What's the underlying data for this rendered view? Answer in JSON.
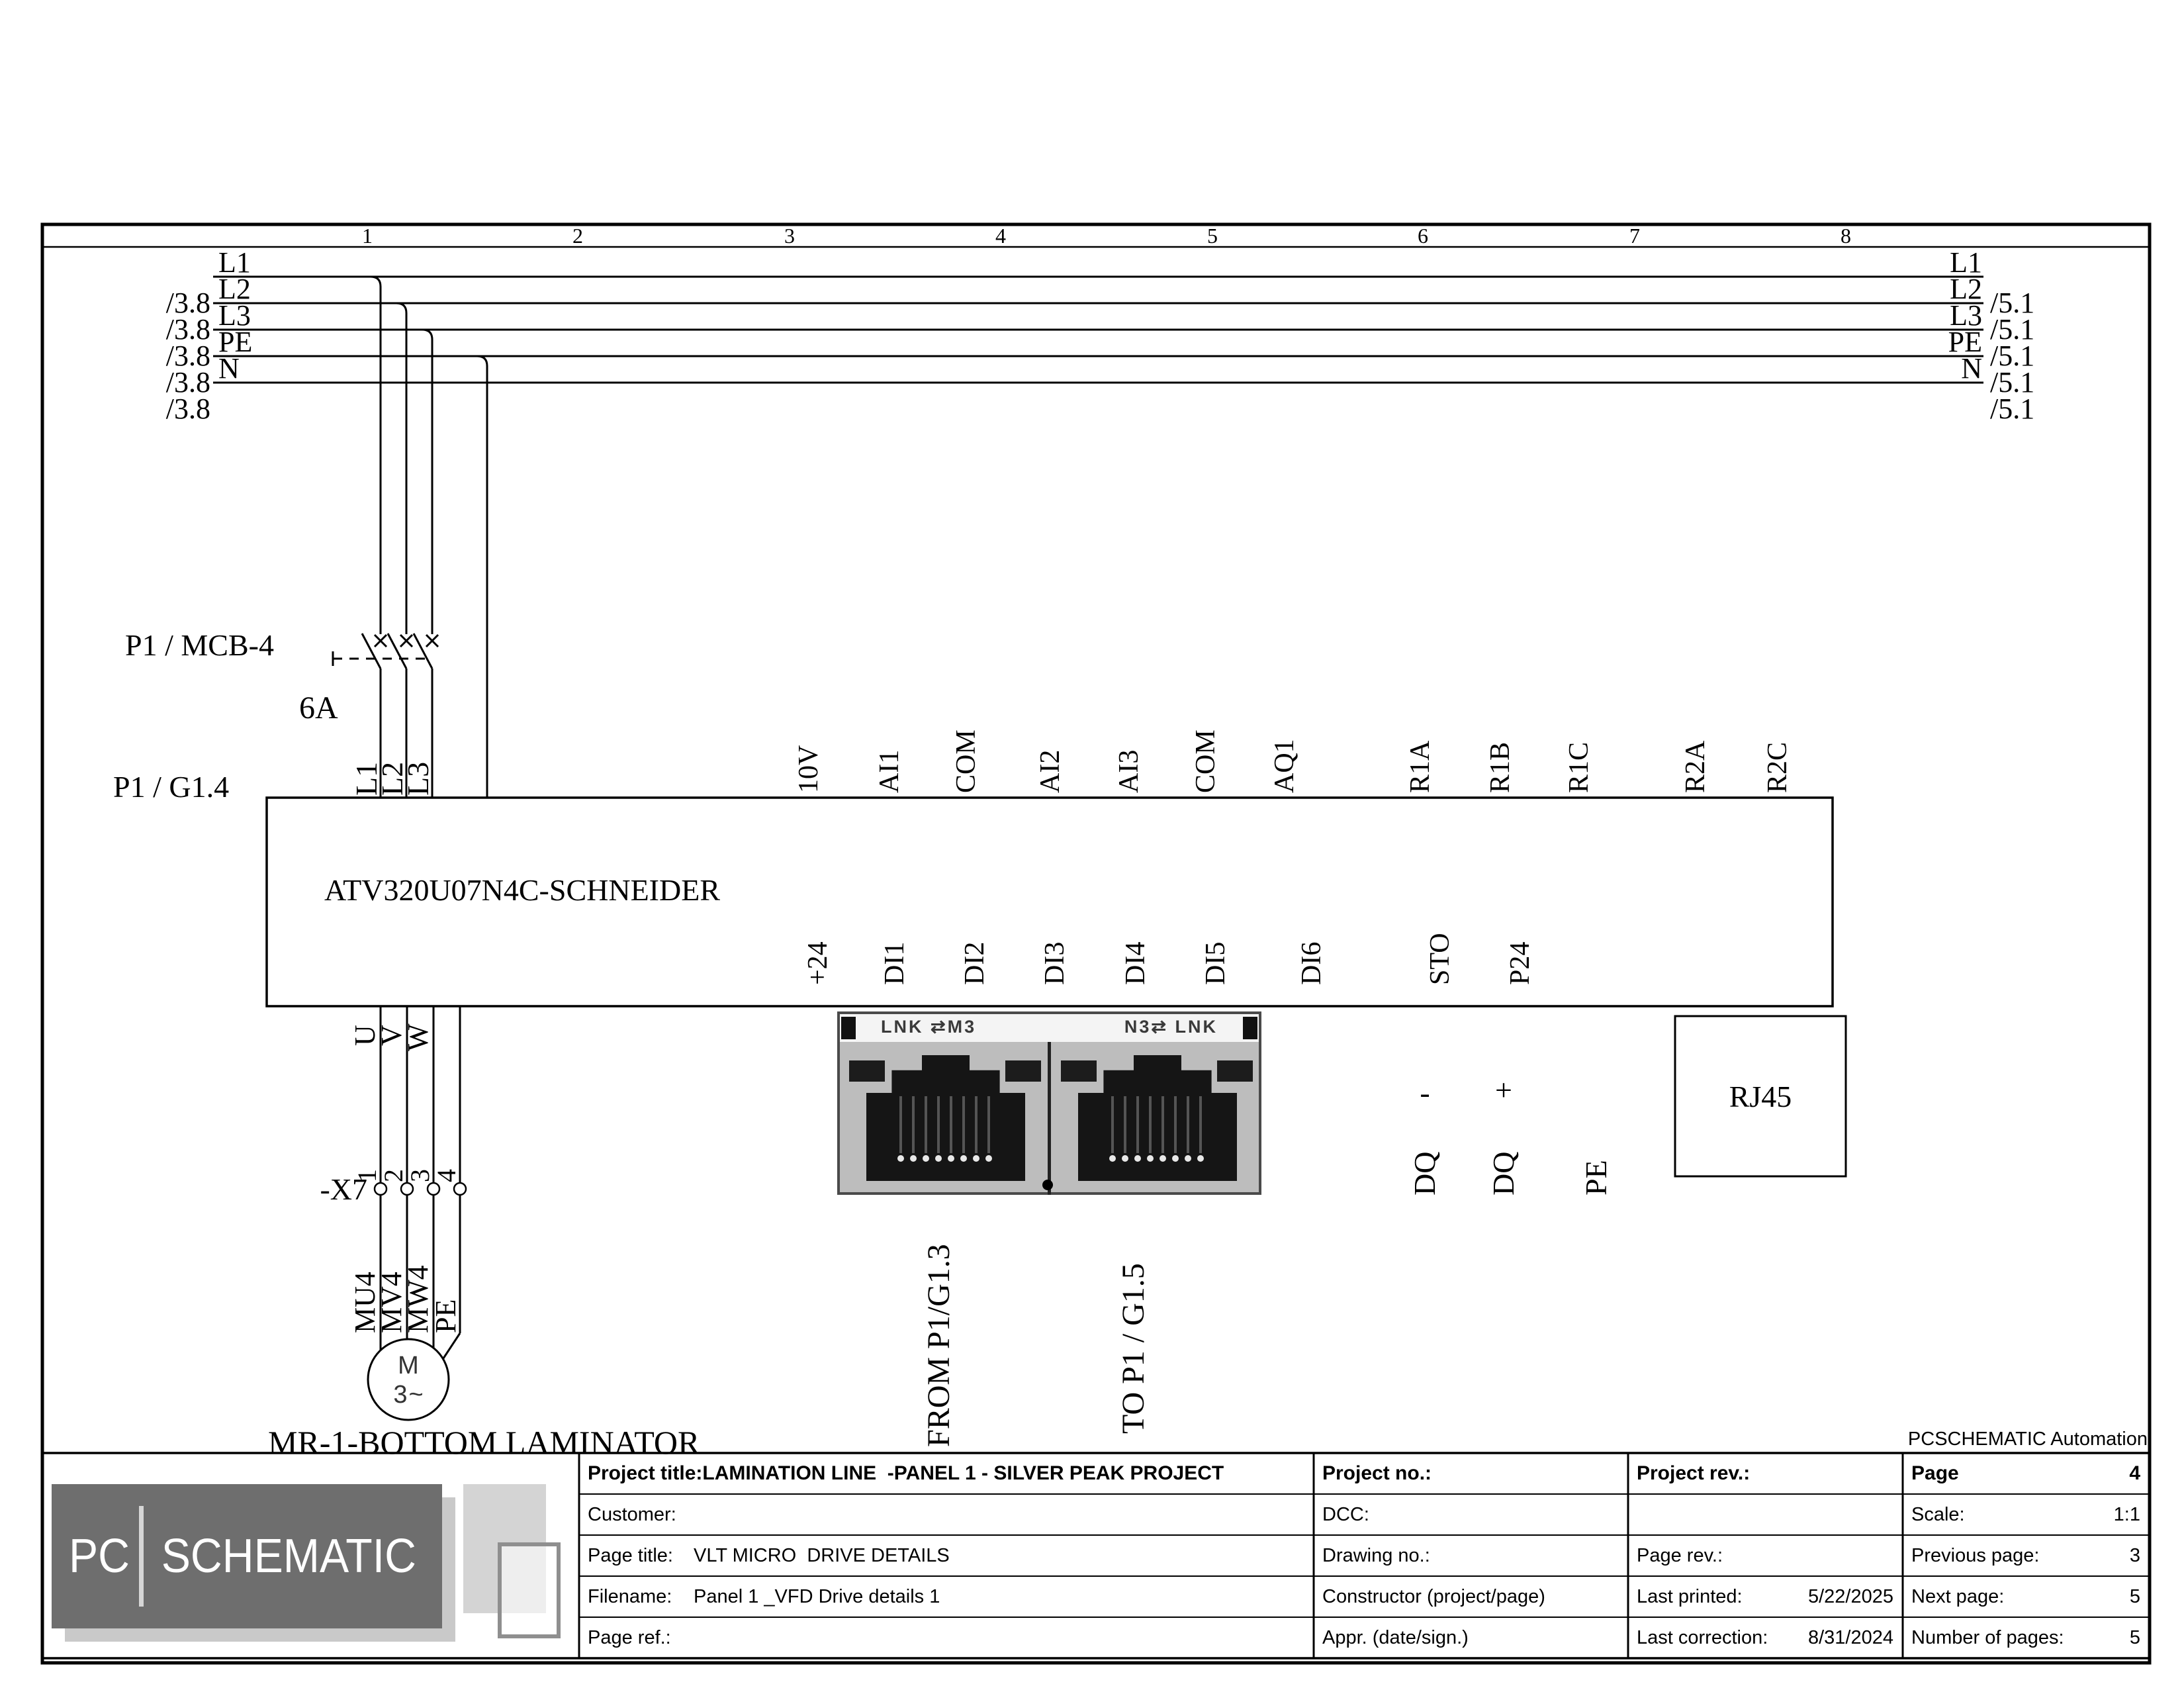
{
  "colors": {
    "ink": "#000000",
    "paper": "#ffffff",
    "logo_gray": "#6e6e6e",
    "logo_shadow": "#c9c9c9",
    "photo_body": "#bdbdbd",
    "photo_dark": "#151515"
  },
  "sheet": {
    "columns": [
      "1",
      "2",
      "3",
      "4",
      "5",
      "6",
      "7",
      "8"
    ],
    "watermark": "PCSCHEMATIC Automation"
  },
  "bus": {
    "left": [
      {
        "ref": "",
        "name": "L1"
      },
      {
        "ref": "/3.8",
        "name": "L2"
      },
      {
        "ref": "/3.8",
        "name": "L3"
      },
      {
        "ref": "/3.8",
        "name": "PE"
      },
      {
        "ref": "/3.8",
        "name": "N"
      },
      {
        "ref": "/3.8",
        "name": ""
      }
    ],
    "right": [
      {
        "name": "L1",
        "ref": ""
      },
      {
        "name": "L2",
        "ref": "/5.1"
      },
      {
        "name": "L3",
        "ref": "/5.1"
      },
      {
        "name": "PE",
        "ref": "/5.1"
      },
      {
        "name": "N",
        "ref": "/5.1"
      },
      {
        "name": "",
        "ref": "/5.1"
      }
    ]
  },
  "breaker": {
    "tag": "P1 / MCB-4",
    "rating": "6A",
    "feed_ref": "P1 / G1.4",
    "phases": [
      "L1",
      "L2",
      "L3"
    ]
  },
  "drive": {
    "model": "ATV320U07N4C-SCHNEIDER",
    "top_terminals": [
      "10V",
      "AI1",
      "COM",
      "AI2",
      "AI3",
      "COM",
      "AQ1",
      "R1A",
      "R1B",
      "R1C",
      "R2A",
      "R2C"
    ],
    "bottom_terminals": [
      "+24",
      "DI1",
      "DI2",
      "DI3",
      "DI4",
      "DI5",
      "DI6",
      "STO",
      "P24"
    ],
    "aux_terminals": [
      {
        "name": "DQ",
        "sign": "-"
      },
      {
        "name": "DQ",
        "sign": "+"
      },
      {
        "name": "PE",
        "sign": ""
      }
    ],
    "output_terminals": [
      "U",
      "V",
      "W"
    ],
    "rj45_label": "RJ45"
  },
  "comm": {
    "left_port": "LNK ⇄M3",
    "right_port": "N3⇄ LNK",
    "from_label": "FROM P1/G1.3",
    "to_label": "TO P1 / G1.5"
  },
  "x7": {
    "tag": "-X7",
    "pins": [
      "1",
      "2",
      "3",
      "4"
    ]
  },
  "motor": {
    "wires": [
      "MU4",
      "MV4",
      "MW4",
      "PE"
    ],
    "symbol_m": "M",
    "symbol_phase": "3~",
    "name": "MR-1-BOTTOM LAMINATOR"
  },
  "logo": {
    "pc": "PC",
    "schematic": "SCHEMATIC"
  },
  "title_block": {
    "project_title_label": "Project title:",
    "project_title": "LAMINATION LINE  -PANEL 1 - SILVER PEAK PROJECT",
    "customer_label": "Customer:",
    "page_title_label": "Page title:",
    "page_title": "VLT MICRO  DRIVE DETAILS",
    "filename_label": "Filename:",
    "filename": "Panel 1 _VFD Drive details 1",
    "page_ref_label": "Page ref.:",
    "project_no_label": "Project no.:",
    "dcc_label": "DCC:",
    "drawing_no_label": "Drawing no.:",
    "constructor_label": "Constructor (project/page)",
    "appr_label": "Appr. (date/sign.)",
    "project_rev_label": "Project rev.:",
    "page_rev_label": "Page rev.:",
    "last_printed_label": "Last printed:",
    "last_printed": "5/22/2025",
    "last_correction_label": "Last correction:",
    "last_correction": "8/31/2024",
    "page_label": "Page",
    "page": "4",
    "scale_label": "Scale:",
    "scale": "1:1",
    "previous_page_label": "Previous page:",
    "previous_page": "3",
    "next_page_label": "Next page:",
    "next_page": "5",
    "num_pages_label": "Number of pages:",
    "num_pages": "5"
  }
}
